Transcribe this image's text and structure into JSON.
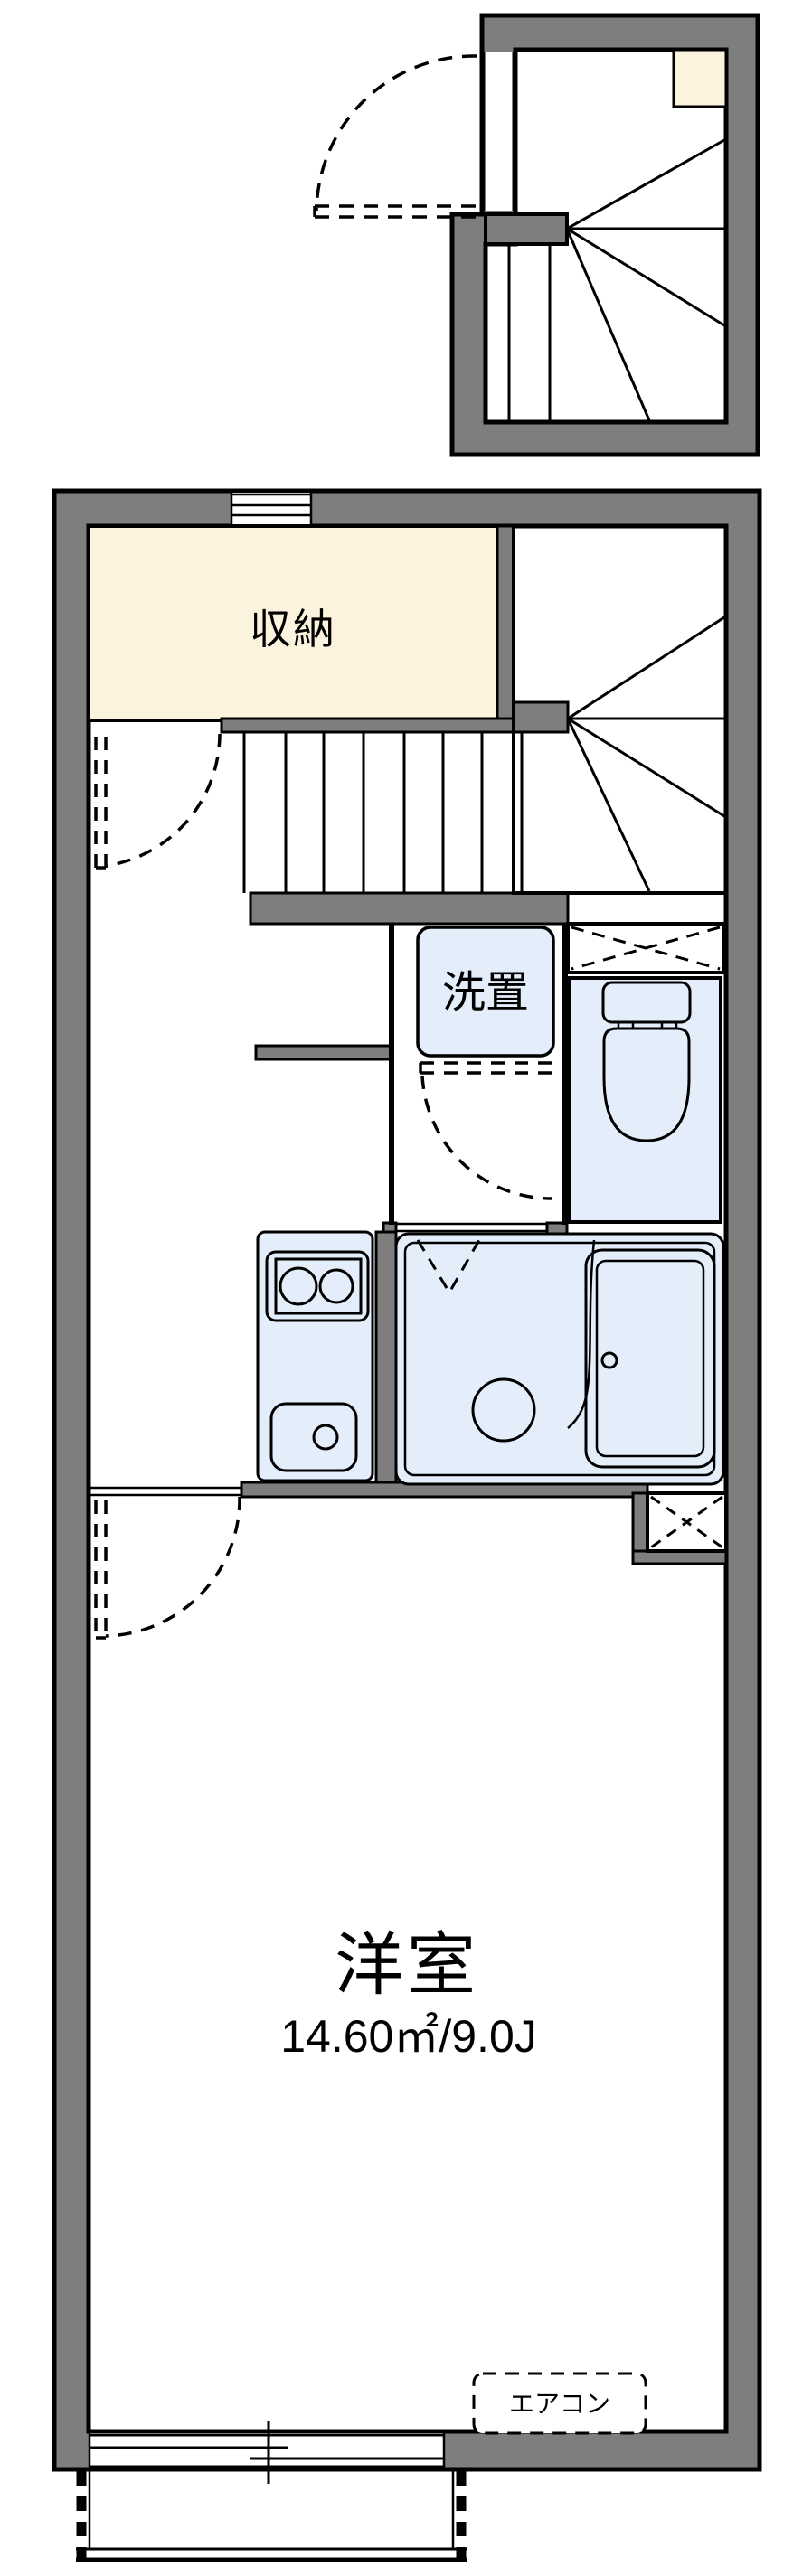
{
  "floorplan": {
    "title": "apartment-floor-plan",
    "labels": {
      "storage": "収納",
      "washer": "洗置",
      "main_room": "洋室",
      "main_room_size": "14.60㎡/9.0J",
      "aircon": "エアコン"
    },
    "rooms": [
      {
        "name": "upper-stairwell",
        "features": [
          "winder-staircase",
          "entry-door",
          "landing-closet"
        ]
      },
      {
        "name": "storage",
        "label": "収納"
      },
      {
        "name": "staircase",
        "features": [
          "straight-run",
          "winder-turn"
        ]
      },
      {
        "name": "washroom",
        "label": "洗置",
        "features": [
          "washing-machine-space",
          "door"
        ]
      },
      {
        "name": "toilet",
        "features": [
          "toilet-bowl",
          "tank",
          "overhead-cabinet-crossbox"
        ]
      },
      {
        "name": "kitchen",
        "features": [
          "two-burner-stove",
          "sink"
        ]
      },
      {
        "name": "bathroom",
        "features": [
          "bathtub",
          "wash-basin",
          "folding-door"
        ]
      },
      {
        "name": "main-room",
        "label": "洋室",
        "size": "14.60㎡/9.0J",
        "features": [
          "aircon-spot",
          "sliding-window",
          "balcony"
        ]
      }
    ],
    "colors": {
      "wall_gray": "#7E7E7E",
      "storage_cream": "#FCF3DF",
      "fixture_blue": "#E4EDFA",
      "line_black": "#000000",
      "background": "#FFFFFF"
    }
  }
}
